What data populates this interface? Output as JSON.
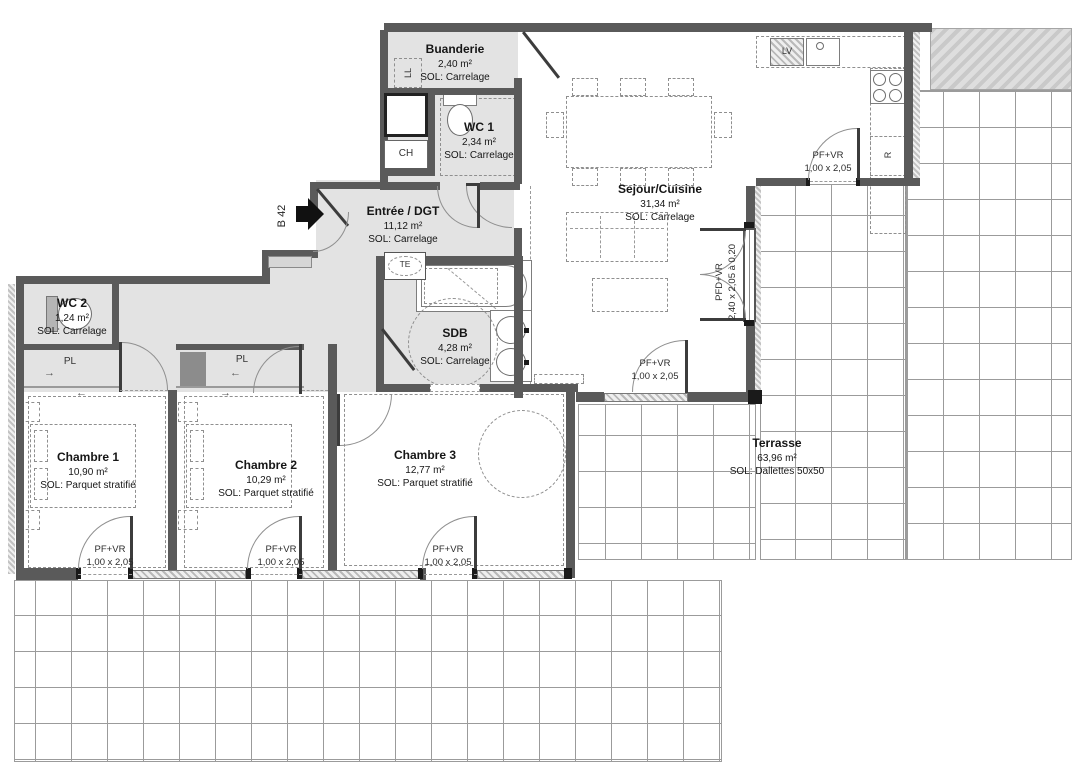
{
  "unit": {
    "label": "B 42"
  },
  "rooms": [
    {
      "name": "Buanderie",
      "area": "2,40 m²",
      "floor": "SOL: Carrelage"
    },
    {
      "name": "WC 1",
      "area": "2,34 m²",
      "floor": "SOL: Carrelage"
    },
    {
      "name": "Entrée / DGT",
      "area": "11,12 m²",
      "floor": "SOL: Carrelage"
    },
    {
      "name": "WC 2",
      "area": "1,24 m²",
      "floor": "SOL: Carrelage"
    },
    {
      "name": "SDB",
      "area": "4,28 m²",
      "floor": "SOL: Carrelage"
    },
    {
      "name": "Sejour/Cuisine",
      "area": "31,34 m²",
      "floor": "SOL: Carrelage"
    },
    {
      "name": "Chambre 1",
      "area": "10,90 m²",
      "floor": "SOL: Parquet stratifié"
    },
    {
      "name": "Chambre 2",
      "area": "10,29 m²",
      "floor": "SOL: Parquet stratifié"
    },
    {
      "name": "Chambre 3",
      "area": "12,77 m²",
      "floor": "SOL: Parquet stratifié"
    },
    {
      "name": "Terrasse",
      "area": "63,96 m²",
      "floor": "SOL: Dallettes 50x50"
    }
  ],
  "openings": [
    {
      "type": "PF+VR",
      "size": "1,00 x 2,05"
    },
    {
      "type": "PFD+VR",
      "size": "2,40 x 2,05 à 0,20"
    },
    {
      "type": "PF+VR",
      "size": "1,00 x 2,05"
    },
    {
      "type": "PF+VR",
      "size": "1,00 x 2,05"
    },
    {
      "type": "PF+VR",
      "size": "1,00 x 2,05"
    },
    {
      "type": "PF+VR",
      "size": "1,00 x 2,05"
    }
  ],
  "fixtures": {
    "washer": "LL",
    "boiler": "CH",
    "electrical_panel": "TE",
    "dishwasher": "LV",
    "fridge": "R",
    "closet_1": "PL",
    "closet_2": "PL"
  },
  "colors": {
    "wall": "#5a5a5a",
    "floor": "#e3e3e3",
    "grid_line": "#9b9b9b",
    "black": "#1a1a1a"
  }
}
